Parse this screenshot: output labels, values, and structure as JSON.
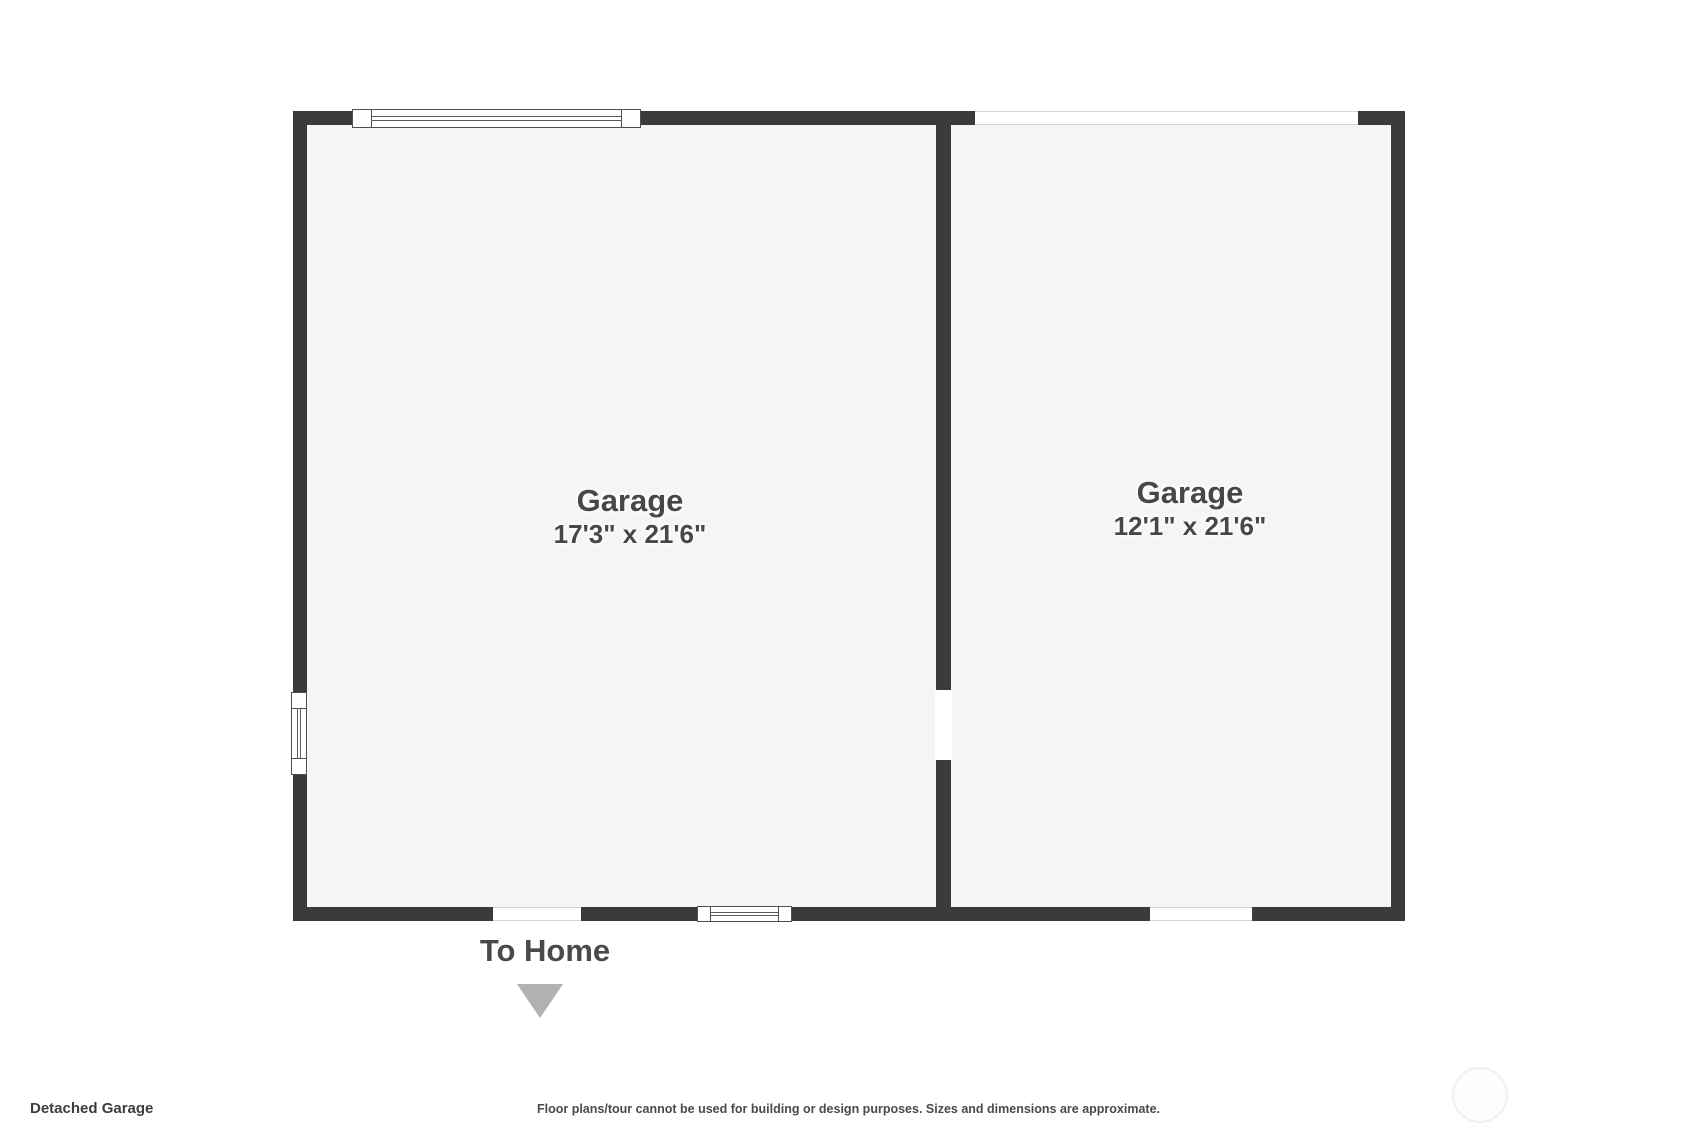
{
  "plan": {
    "rooms": [
      {
        "label": "Garage",
        "dimensions": "17'3\" x 21'6\""
      },
      {
        "label": "Garage",
        "dimensions": "12'1\" x 21'6\""
      }
    ],
    "to_home_label": "To Home",
    "features": {
      "top_left": "window",
      "top_right": "garage-door-opening",
      "left_wall": "window",
      "bottom_left": "door-opening-to-home",
      "bottom_center": "window",
      "bottom_right": "door-opening",
      "middle_wall": "open-passage-between-garages"
    },
    "colors": {
      "wall": "#3b3b3b",
      "floor": "#f5f5f5",
      "label_text": "#474747",
      "arrow": "#b1b1b1",
      "background": "#ffffff"
    }
  },
  "footer": {
    "plan_title": "Detached Garage",
    "disclaimer": "Floor plans/tour cannot be used for building or design purposes. Sizes and dimensions are approximate."
  }
}
